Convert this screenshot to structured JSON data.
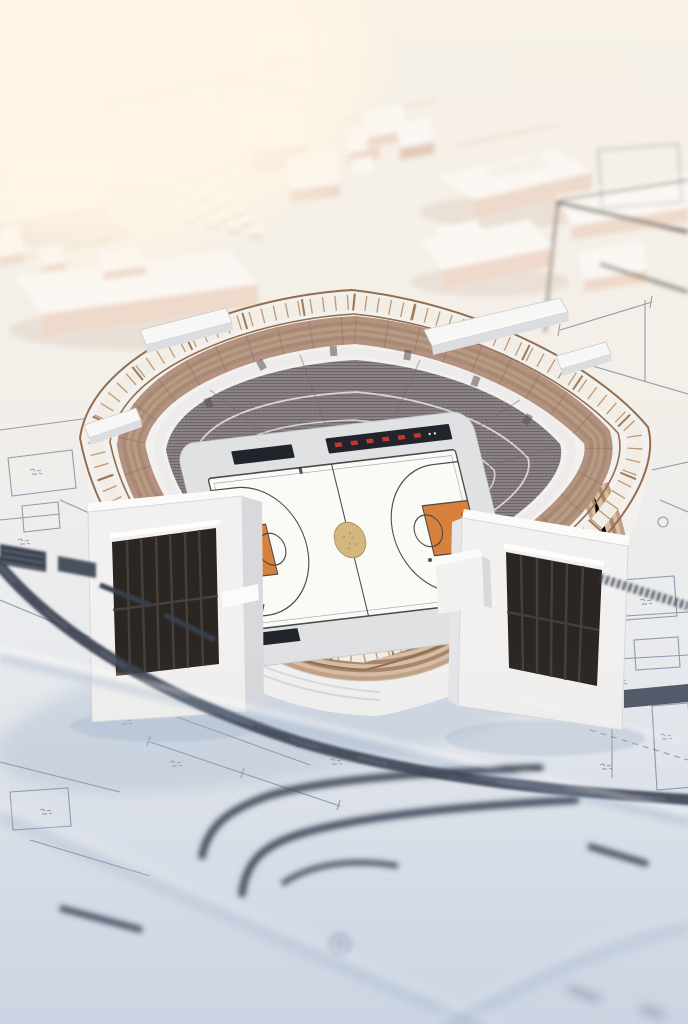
{
  "scene": {
    "subject": "Miniature 3D basketball stadium model standing on layered architectural blueprint plans",
    "style": "physical architectural scale model render, shallow depth of field",
    "view": "high three-quarter aerial view",
    "lighting": "soft warm daylight from upper left",
    "city": {
      "description": "blurred white massing blocks of surrounding buildings on cream ground",
      "features": [
        "large flat-roof blocks",
        "4x4 grid of small cube pavilions",
        "stippled rooftop slab",
        "faint tan road lines",
        "dark road bands upper right"
      ]
    },
    "stadium": {
      "shape": "rounded-square open bowl",
      "rim": "bronze truss ring with white glass panels and annotated paper band",
      "upper_deck": "tan seating tiers with aisle ticks",
      "concourse": "white walkway ring",
      "lower_bowl": "grey fine-textured seating",
      "facade": "white walls, curved tan louver bands, two entrance pavilions with dark slatted doors",
      "rooftop_canopies": 4
    },
    "court": {
      "sport": "basketball",
      "floor": "white",
      "center_circle": "gold emblem",
      "keys": "orange, both ends",
      "side_elements": [
        "black scorer tables",
        "dark LED banner with red segments"
      ]
    },
    "ground": {
      "description": "white-blue blueprint plinth with technical linework",
      "features": [
        "thin blueprint lines",
        "handwritten annotation scribbles",
        "dimension lines",
        "dark curved road bands",
        "hatched dark bars",
        "stepped slab edges",
        "small circular rivet pad"
      ]
    }
  },
  "palette": {
    "bg_top": "#f7f1e7",
    "bg_mid": "#f3efe9",
    "bg_low": "#e9ebee",
    "plinth": "#dfe5ee",
    "building_top": "#fbf7f2",
    "building_side": "#eed9ca",
    "building_side_dark": "#e3cbb9",
    "road_tan": "#d8b794",
    "rim_bronze": "#946d4d",
    "rim_bronze_light": "#b08a66",
    "panel_white": "#f3eee5",
    "deck_tan": "#b3937f",
    "deck_tan_dark": "#8d6f5e",
    "louver_light": "#d6bda4",
    "louver_tan": "#c2a183",
    "louver_tan_dark": "#a7876c",
    "concourse_white": "#eeeceb",
    "seat_grey": "#8b8387",
    "seat_grey_dark": "#6e666b",
    "wall_white": "#f2f1ef",
    "wall_shade": "#d9d9dd",
    "floor_grey": "#e0e1e3",
    "court_white": "#fafaf7",
    "court_line": "#4a4a4a",
    "key_orange": "#d8813c",
    "circle_gold": "#d3b77f",
    "gold_dark": "#a98f54",
    "banner_dark": "#22242c",
    "banner_red": "#c03a30",
    "door_dark": "#2b2622",
    "door_slat": "#4a433c",
    "blueprint_line": "#49587a",
    "road_dark": "#39404f",
    "ink_dark": "#5f544b",
    "shadow_cool": "#9db0c8"
  }
}
